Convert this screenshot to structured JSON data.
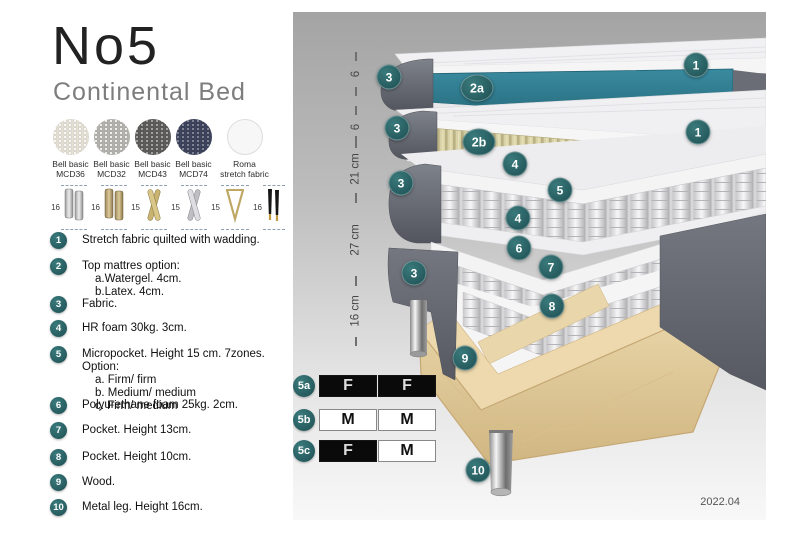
{
  "header": {
    "title": "No5",
    "subtitle": "Continental Bed"
  },
  "fabrics": [
    {
      "name": "Bell basic\nMCD36"
    },
    {
      "name": "Bell basic\nMCD32"
    },
    {
      "name": "Bell basic\nMCD43"
    },
    {
      "name": "Bell basic\nMCD74"
    },
    {
      "name": "Roma\nstretch fabric"
    }
  ],
  "legs": [
    {
      "height": "16"
    },
    {
      "height": "16"
    },
    {
      "height": "15"
    },
    {
      "height": "15"
    },
    {
      "height": "15"
    },
    {
      "height": "16"
    }
  ],
  "spec_list": [
    {
      "num": "1",
      "text": "Stretch fabric quilted with wadding.",
      "sub": "",
      "y": 232
    },
    {
      "num": "2",
      "text": "Top mattres option:",
      "sub": "a.Watergel. 4cm.\nb.Latex. 4cm.",
      "y": 258
    },
    {
      "num": "3",
      "text": "Fabric.",
      "sub": "",
      "y": 296
    },
    {
      "num": "4",
      "text": "HR foam 30kg. 3cm.",
      "sub": "",
      "y": 320
    },
    {
      "num": "5",
      "text": "Micropocket. Height 15 cm. 7zones. Option:",
      "sub": "a. Firm/ firm\nb. Medium/ medium\nc. Firm/ medium",
      "y": 346
    },
    {
      "num": "6",
      "text": "Polyurethane foam 25kg. 2cm.",
      "sub": "",
      "y": 397
    },
    {
      "num": "7",
      "text": "Pocket. Height 13cm.",
      "sub": "",
      "y": 422
    },
    {
      "num": "8",
      "text": "Pocket. Height 10cm.",
      "sub": "",
      "y": 449
    },
    {
      "num": "9",
      "text": "Wood.",
      "sub": "",
      "y": 474
    },
    {
      "num": "10",
      "text": "Metal leg. Height 16cm.",
      "sub": "",
      "y": 499
    }
  ],
  "diagram": {
    "dimensions": [
      {
        "label": "6",
        "top": 40,
        "height": 44
      },
      {
        "label": "6",
        "top": 94,
        "height": 42
      },
      {
        "label": "21 cm",
        "top": 124,
        "height": 66
      },
      {
        "label": "27 cm",
        "top": 182,
        "height": 92
      },
      {
        "label": "16 cm",
        "top": 264,
        "height": 70
      }
    ],
    "callouts": [
      {
        "label": "3",
        "x": 96,
        "y": 65
      },
      {
        "label": "2a",
        "x": 184,
        "y": 76,
        "wide": true
      },
      {
        "label": "1",
        "x": 403,
        "y": 53
      },
      {
        "label": "3",
        "x": 104,
        "y": 116
      },
      {
        "label": "2b",
        "x": 186,
        "y": 130,
        "wide": true
      },
      {
        "label": "1",
        "x": 405,
        "y": 120
      },
      {
        "label": "4",
        "x": 222,
        "y": 152
      },
      {
        "label": "5",
        "x": 267,
        "y": 178
      },
      {
        "label": "3",
        "x": 108,
        "y": 171
      },
      {
        "label": "4",
        "x": 225,
        "y": 206
      },
      {
        "label": "6",
        "x": 226,
        "y": 236
      },
      {
        "label": "3",
        "x": 121,
        "y": 261
      },
      {
        "label": "7",
        "x": 258,
        "y": 255
      },
      {
        "label": "8",
        "x": 259,
        "y": 294
      },
      {
        "label": "9",
        "x": 172,
        "y": 346
      },
      {
        "label": "10",
        "x": 185,
        "y": 458
      }
    ],
    "firmness": {
      "rows": [
        {
          "opt": "5a",
          "y": 363,
          "cells": [
            {
              "text": "F",
              "variant": "dark"
            },
            {
              "text": "F",
              "variant": "dark"
            }
          ]
        },
        {
          "opt": "5b",
          "y": 397,
          "cells": [
            {
              "text": "M",
              "variant": "light"
            },
            {
              "text": "M",
              "variant": "light"
            }
          ]
        },
        {
          "opt": "5c",
          "y": 428,
          "cells": [
            {
              "text": "F",
              "variant": "dark"
            },
            {
              "text": "M",
              "variant": "light"
            }
          ]
        }
      ]
    },
    "version": "2022.04"
  },
  "colors": {
    "callout_teal": "#2e6b6e",
    "layer_2a_teal": "#2f7f93",
    "latex_cream": "#d8d1a4",
    "base_fabric_gray": "#5d6068",
    "wood": "#ecd9ad",
    "table_dark": "#0a0a0a",
    "panel_bg_top": "#a4a4a4",
    "panel_bg_bottom": "#f8f8f8"
  }
}
